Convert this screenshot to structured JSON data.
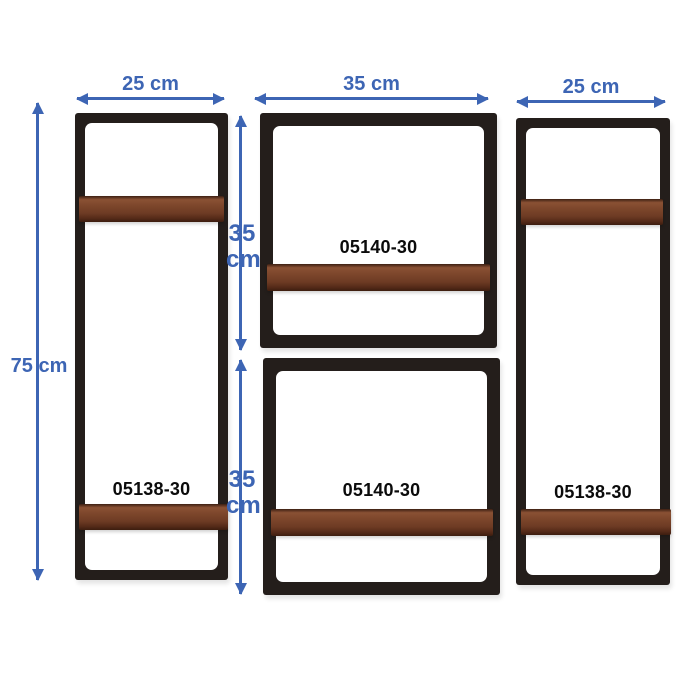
{
  "colors": {
    "accent_blue": "#3d65b4",
    "frame": "#241e1b",
    "wood_mid": "#7c462b",
    "background": "#ffffff"
  },
  "shelves": {
    "left_tall": {
      "product_label": "05138-30"
    },
    "top_square": {
      "product_label": "05140-30"
    },
    "bottom_square": {
      "product_label": "05140-30"
    },
    "right_tall": {
      "product_label": "05138-30"
    }
  },
  "dimensions": {
    "left_width": "25 cm",
    "middle_width": "35 cm",
    "right_width": "25 cm",
    "total_height": "75 cm",
    "top_square_height_value": "35",
    "top_square_height_unit": "cm",
    "bottom_square_height_value": "35",
    "bottom_square_height_unit": "cm"
  }
}
